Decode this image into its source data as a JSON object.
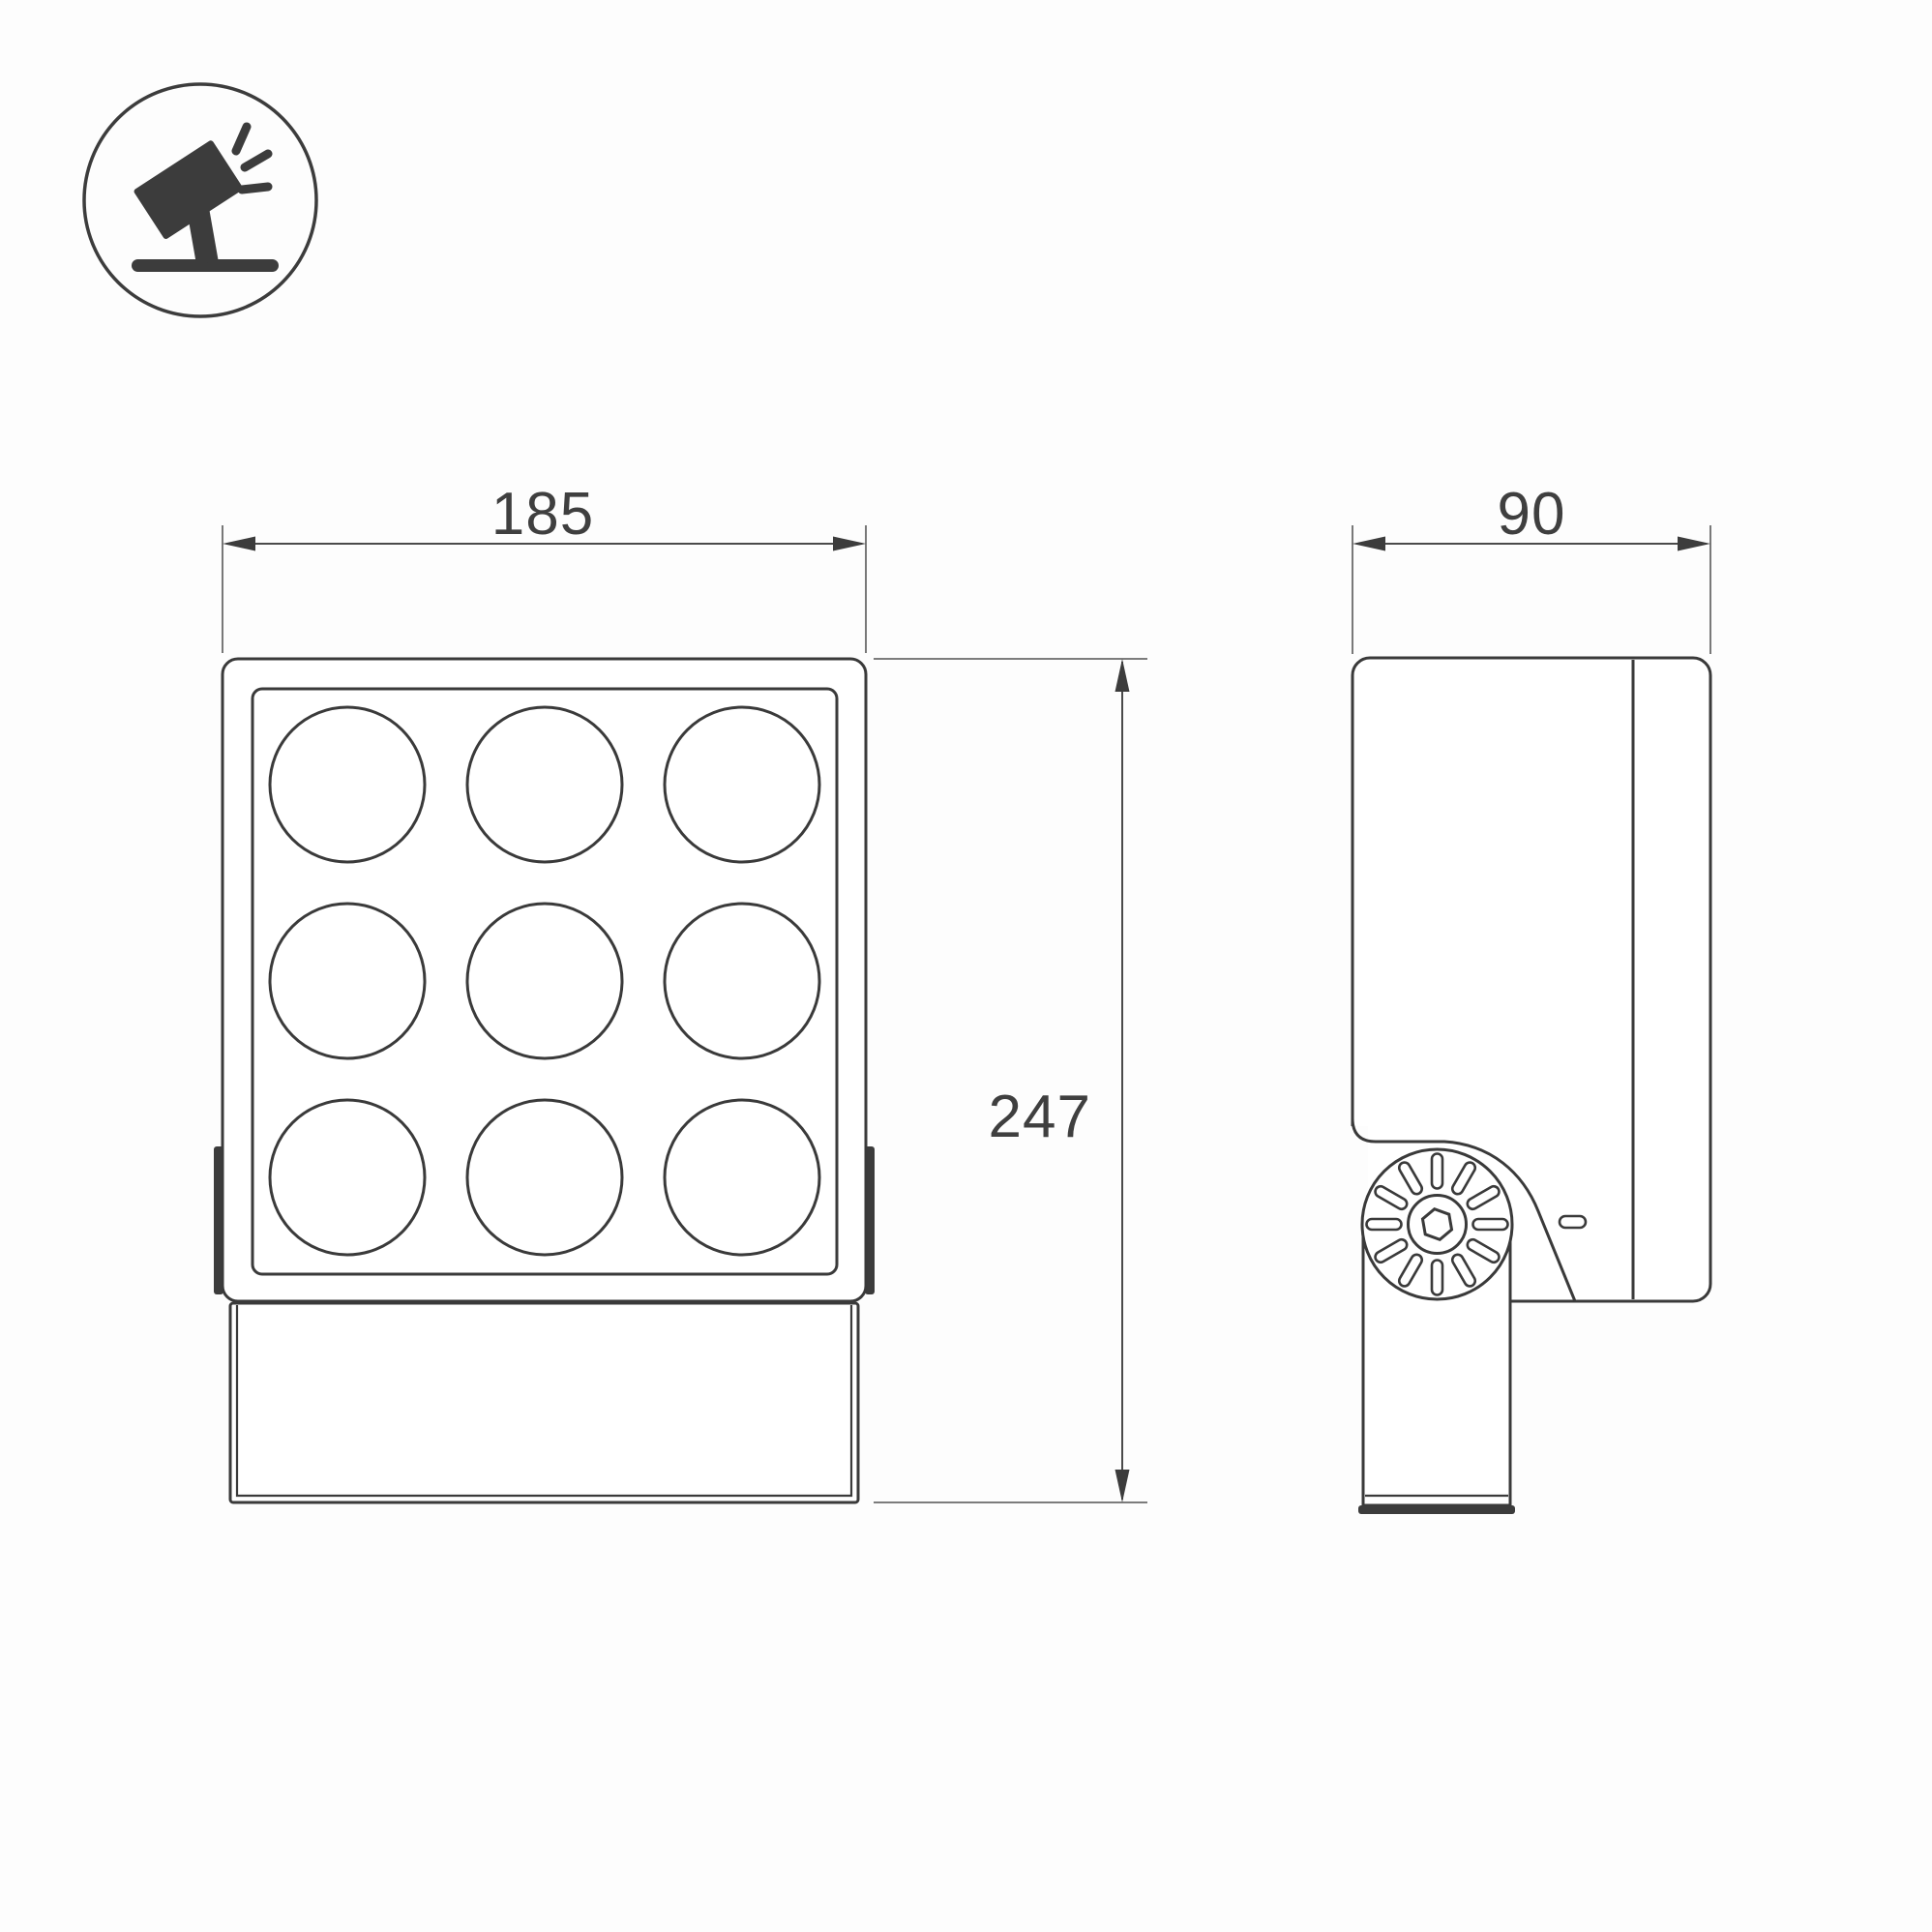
{
  "page": {
    "background": "#fdfdfd",
    "line_color": "#3a3a3a",
    "text_color": "#3f3f3f",
    "type": "technical-dimension-drawing"
  },
  "legend_icon": {
    "name": "adjustable-floodlight-icon",
    "description": "tilted floodlight on stand emitting light"
  },
  "views": {
    "front": {
      "name": "front-view",
      "lens_rows": 3,
      "lens_cols": 3,
      "lens_count": 9
    },
    "side": {
      "name": "side-view",
      "features": [
        "knurled-adjustment-knob",
        "hex-socket-bolt",
        "mounting-arm"
      ]
    }
  },
  "dimensions": {
    "front_width_mm": "185",
    "side_depth_mm": "90",
    "front_height_mm": "247"
  }
}
